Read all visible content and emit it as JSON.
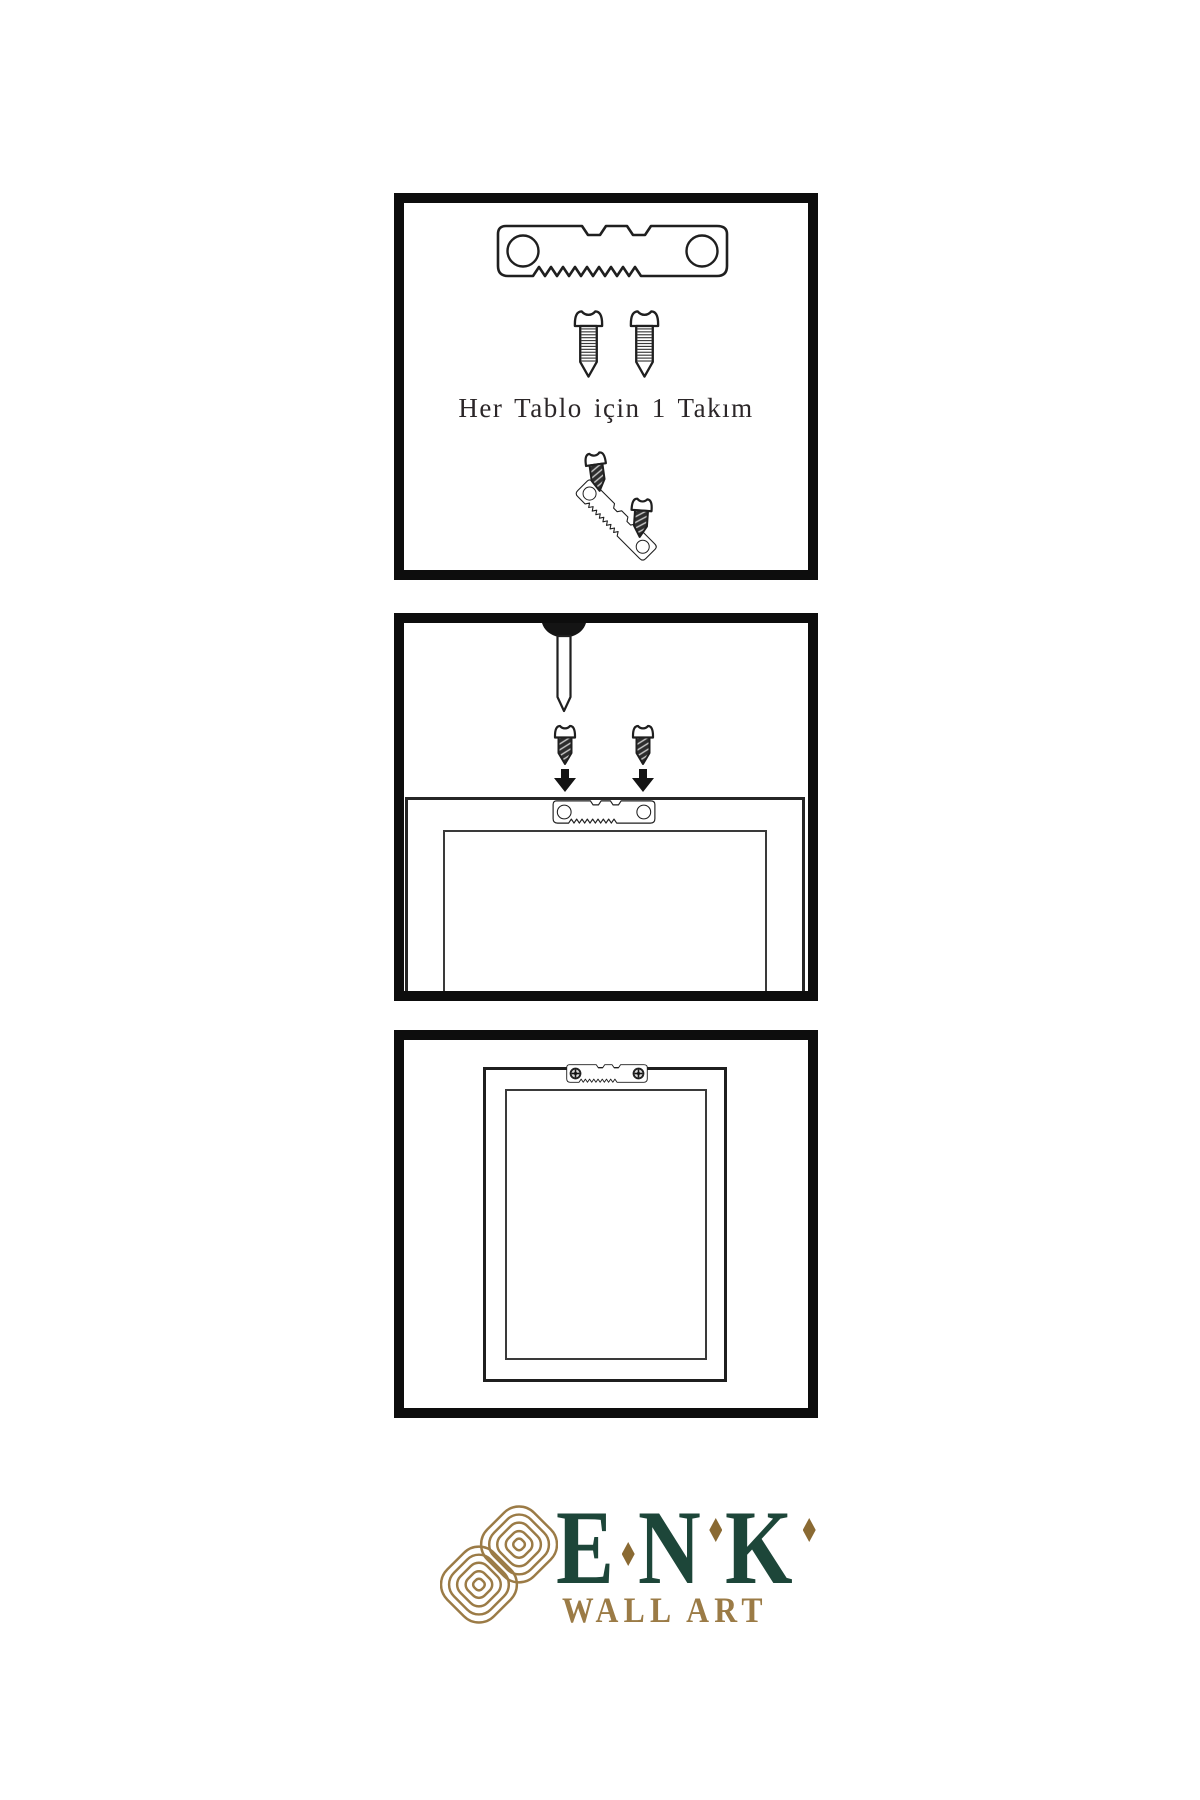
{
  "page": {
    "width": 1200,
    "height": 1800,
    "background": "#ffffff",
    "ink": "#1f1f1f",
    "panel_border_color": "#0d0d0d"
  },
  "steps": [
    {
      "name": "hardware-kit",
      "caption": "Her Tablo için 1 Takım",
      "items": [
        "sawtooth-hanger-icon",
        "screw-icon",
        "screw-icon",
        "screw-into-hanger-icon"
      ]
    },
    {
      "name": "mount-hanger-on-frame-back",
      "items": [
        "nail-icon",
        "screw-dark-icon",
        "arrow-down-icon",
        "frame-back",
        "sawtooth-hanger-icon"
      ]
    },
    {
      "name": "frame-hung-on-wall",
      "items": [
        "frame-back",
        "sawtooth-hanger-screwed-icon"
      ]
    }
  ],
  "logo": {
    "brand": "ENK",
    "brand_letters": [
      "E",
      "N",
      "K"
    ],
    "tagline": "WALL ART",
    "brand_color": "#1d4639",
    "gold": "#9b7b46",
    "diamond_gold": "#8a6a33",
    "mark": "knot-logo-icon"
  },
  "icons": {
    "sawtooth_hanger": "sawtooth-hanger-icon",
    "screw_white": "screw-icon",
    "screw_dark": "screw-dark-icon",
    "arrow_down": "arrow-down-icon",
    "nail": "nail-icon",
    "knot_mark": "knot-logo-icon"
  }
}
